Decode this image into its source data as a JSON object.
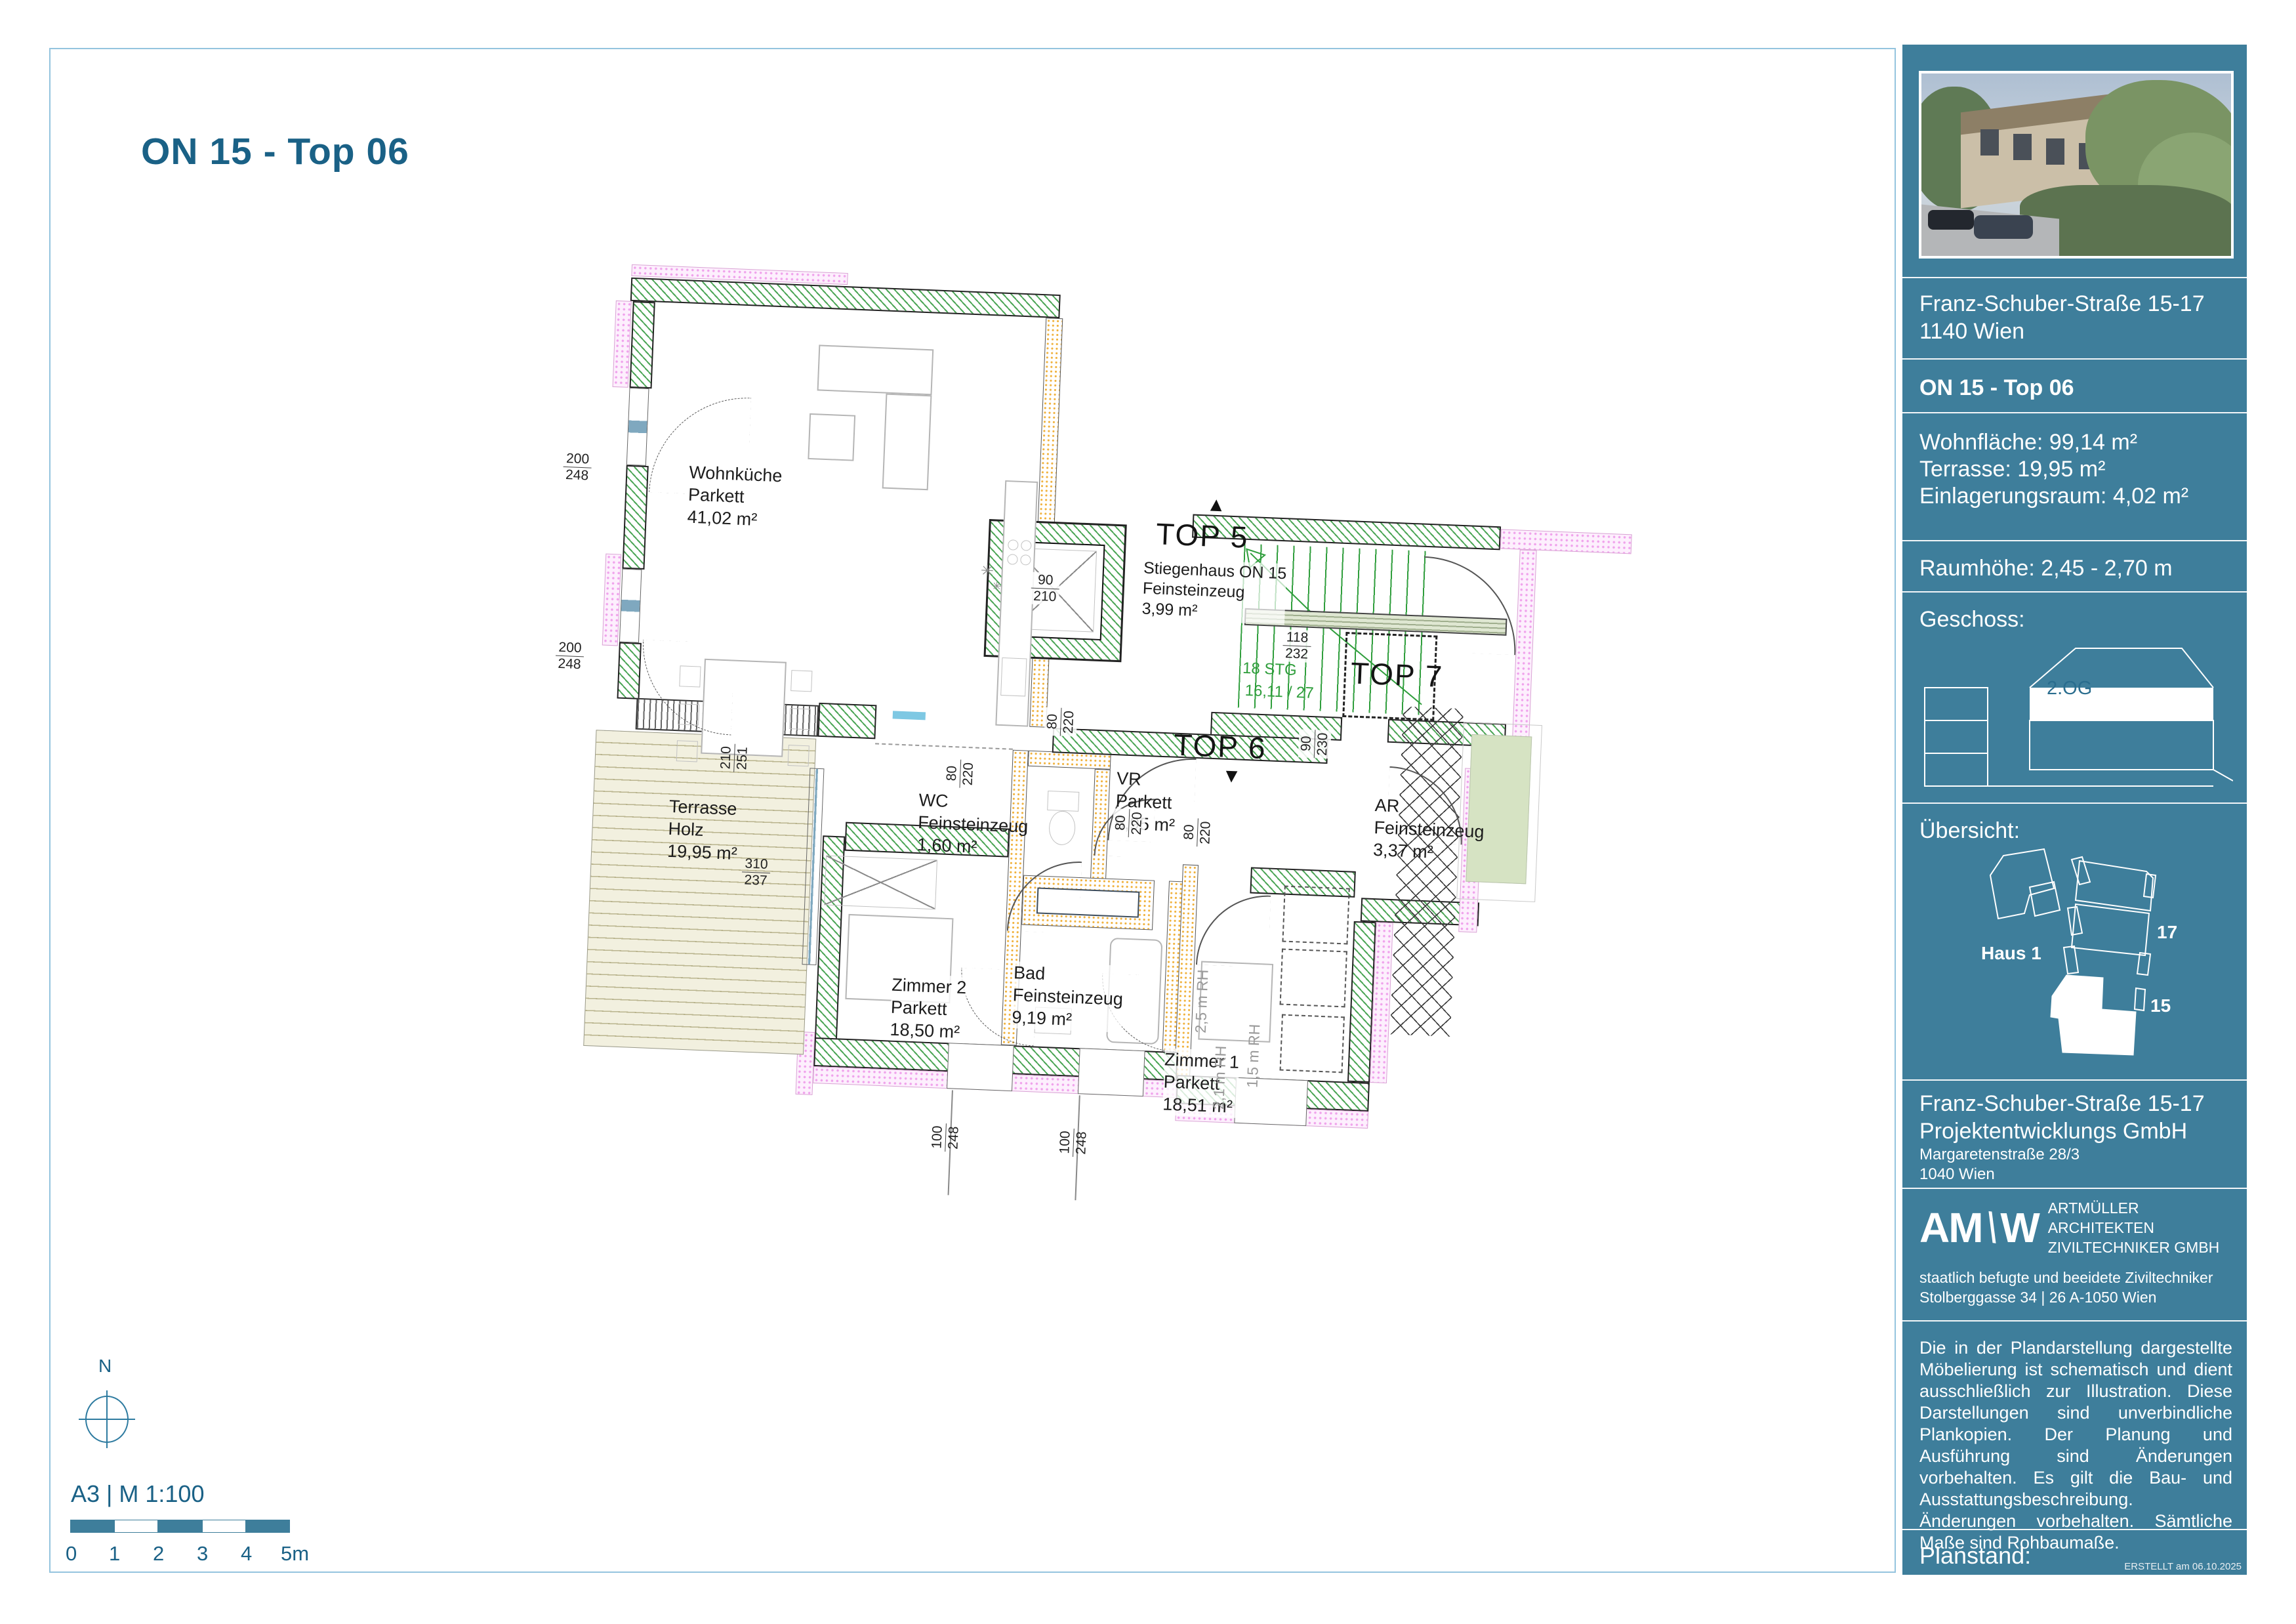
{
  "page": {
    "title": "ON 15 - Top 06"
  },
  "footer": {
    "north": "N",
    "format": "A3  |  M 1:100",
    "scale_ticks": [
      "0",
      "1",
      "2",
      "3",
      "4",
      "5m"
    ]
  },
  "plan": {
    "tops": {
      "top5": "TOP 5",
      "top6": "TOP 6",
      "top7": "TOP 7"
    },
    "icons": {
      "arrow_up": "▲",
      "arrow_down": "▼",
      "snowflake": "✳"
    },
    "rooms": [
      {
        "name": "Wohnküche",
        "floor": "Parkett",
        "area": "41,02 m²"
      },
      {
        "name": "Terrasse",
        "floor": "Holz",
        "area": "19,95 m²"
      },
      {
        "name": "Stiegenhaus ON 15",
        "floor": "Feinsteinzeug",
        "area": "3,99 m²"
      },
      {
        "name": "VR",
        "floor": "Parkett",
        "area": "6,95 m²"
      },
      {
        "name": "AR",
        "floor": "Feinsteinzeug",
        "area": "3,37 m²"
      },
      {
        "name": "WC",
        "floor": "Feinsteinzeug",
        "area": "1,60 m²"
      },
      {
        "name": "Bad",
        "floor": "Feinsteinzeug",
        "area": "9,19 m²"
      },
      {
        "name": "Zimmer 2",
        "floor": "Parkett",
        "area": "18,50 m²"
      },
      {
        "name": "Zimmer 1",
        "floor": "Parkett",
        "area": "18,51 m²"
      }
    ],
    "stairs": {
      "steps": "18 STG",
      "rise": "16,11 / 27"
    },
    "rh_labels": [
      "2,5 m RH",
      "2,1 m RH",
      "1,5 m RH"
    ],
    "dims": [
      {
        "top": "200",
        "bottom": "248"
      },
      {
        "top": "200",
        "bottom": "248"
      },
      {
        "top": "90",
        "bottom": "210"
      },
      {
        "top": "118",
        "bottom": "232"
      },
      {
        "top": "80",
        "bottom": "220"
      },
      {
        "top": "80",
        "bottom": "220"
      },
      {
        "top": "80",
        "bottom": "220"
      },
      {
        "top": "90",
        "bottom": "230"
      },
      {
        "top": "80",
        "bottom": "220"
      },
      {
        "top": "210",
        "bottom": "251"
      },
      {
        "top": "310",
        "bottom": "237"
      },
      {
        "top": "100",
        "bottom": "248"
      },
      {
        "top": "100",
        "bottom": "248"
      }
    ]
  },
  "sidebar": {
    "address_line1": "Franz-Schuber-Straße 15-17",
    "address_line2": "1140 Wien",
    "unit": "ON 15 - Top 06",
    "metrics": [
      {
        "label": "Wohnfläche:",
        "value": "99,14 m²"
      },
      {
        "label": "Terrasse:",
        "value": "19,95  m²"
      },
      {
        "label": "Einlagerungsraum:",
        "value": "4,02 m²"
      }
    ],
    "room_height": "Raumhöhe:  2,45 - 2,70 m",
    "floor_section_label": "Geschoss:",
    "floor_highlight": "2.OG",
    "overview_label": "Übersicht:",
    "overview_haus1": "Haus 1",
    "overview_n17": "17",
    "overview_n15": "15",
    "developer_line1": "Franz-Schuber-Straße 15-17",
    "developer_line2": "Projektentwicklungs GmbH",
    "developer_line3": "Margaretenstraße 28/3",
    "developer_line4": "1040 Wien",
    "logo_left": "AM",
    "logo_slash": "\\",
    "logo_right": "W",
    "architect_line1": "ARTMÜLLER ARCHITEKTEN",
    "architect_line2": "ZIVILTECHNIKER GMBH",
    "cert_line1": "staatlich befugte und beeidete Ziviltechniker",
    "cert_line2": "Stolberggasse 34  |  26     A-1050 Wien",
    "disclaimer": "Die in der Plandarstellung dargestellte Möbelierung ist schematisch und dient ausschließlich zur Illustration. Diese Darstellungen sind unverbindliche Plankopien. Der Planung und Ausführung sind Änderungen vorbehalten. Es gilt die Bau- und Ausstattungsbeschreibung. Änderungen vorbehalten. Sämtliche Maße sind Rohbaumaße.",
    "plan_status_label": "Planstand:",
    "created": "ERSTELLT am 06.10.2025"
  }
}
